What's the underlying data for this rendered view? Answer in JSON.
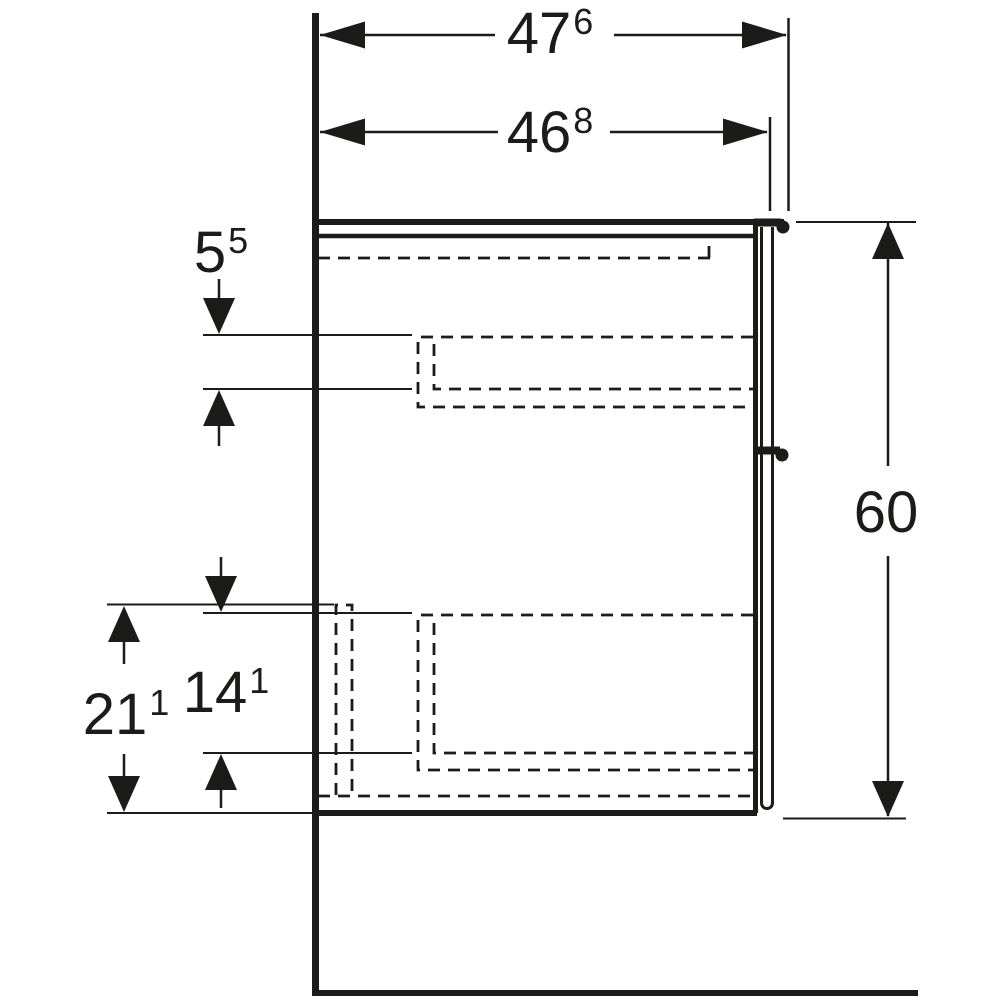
{
  "page": {
    "background": "#ffffff",
    "line_color": "#1b1b19"
  },
  "drawing": {
    "name": "vanity-cabinet-side-view",
    "description": "Technical side-section drawing of a wall-hung bathroom vanity cabinet with two internal drawers (hidden edges dashed), wall and floor reference lines, and six dimension callouts in cm with mm superscripts.",
    "dims": {
      "overall_depth": {
        "main": "47",
        "sup": "6"
      },
      "front_depth": {
        "main": "46",
        "sup": "8"
      },
      "upper_inset": {
        "main": "5",
        "sup": "5"
      },
      "height": {
        "main": "60",
        "sup": ""
      },
      "lower_outer": {
        "main": "21",
        "sup": "1"
      },
      "lower_inner": {
        "main": "14",
        "sup": "1"
      }
    }
  }
}
